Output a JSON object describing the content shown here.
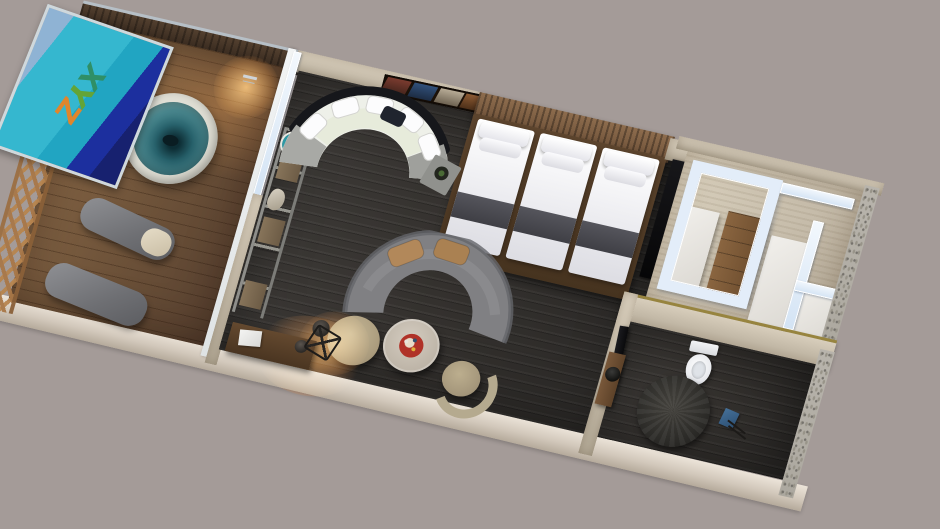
{
  "scene": {
    "type": "3d-floorplan-render",
    "description": "Top-down 3D render of a hotel suite: wood terrace with hot tub and loungers, triple-bed bedroom with curved sofas, walk-in closet with glass partitions, and bathroom",
    "background_color": "#a49b98",
    "rotation_deg": 16
  },
  "signage": {
    "text": "XYZ",
    "letters": [
      {
        "char": "X",
        "color": "#2f8f66"
      },
      {
        "char": "Y",
        "color": "#63a437"
      },
      {
        "char": "Z",
        "color": "#e0862c"
      }
    ],
    "panel_colors": [
      "#8fb3d4",
      "#35b7cf",
      "#1c2f9e"
    ]
  },
  "palette": {
    "deck_wood": "#7a5e41",
    "dark_floor": "#363330",
    "wall_beige": "#ccc2b0",
    "wall_dark_wood": "#3b2d23",
    "glass": "#d9e7f5",
    "tub_water": "#4f8f96",
    "gold_trim": "#97843f",
    "sofa_white": "#eef0e9",
    "sofa_gray": "#808083",
    "cushion_tan": "#b0885a",
    "bed_linen": "#f4f4f6",
    "bed_runner": "#4b4b50",
    "furniture_wood": "#7d5a3a",
    "outer_wall": "#d7cec2"
  },
  "rooms": [
    {
      "name": "terrace",
      "items": [
        "glass-canopy",
        "hot-tub",
        "faucet",
        "lounge-chair",
        "lounge-chair",
        "pergola-lattice",
        "wood-deck"
      ]
    },
    {
      "name": "bedroom-living",
      "items": [
        "curved-white-sofa",
        "side-table",
        "wall-art",
        "slatted-headboard",
        "bed",
        "bed",
        "bed",
        "ladder-shelf",
        "curved-gray-sofa",
        "ottoman",
        "floor-lamp",
        "coffee-table",
        "armchair",
        "desk",
        "desk-chair",
        "mirror-panel"
      ]
    },
    {
      "name": "walk-in-closet",
      "items": [
        "glass-partition",
        "glass-partition",
        "dresser",
        "wardrobe",
        "wardrobe",
        "luggage-bench"
      ]
    },
    {
      "name": "bathroom",
      "items": [
        "toilet",
        "round-rug",
        "vanity-sink",
        "door-panel",
        "towel-stand"
      ]
    }
  ]
}
